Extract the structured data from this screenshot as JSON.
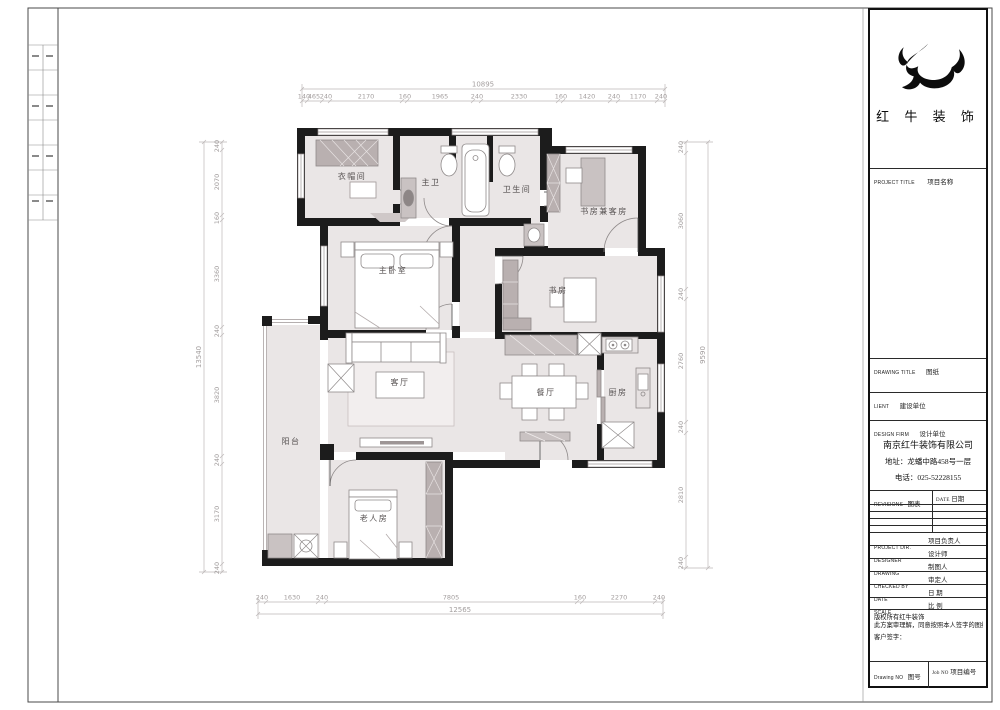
{
  "title_block": {
    "brand": "红 牛 装 饰",
    "rows": {
      "project_title_en": "PROJECT TITLE",
      "project_title_cn": "项目名称",
      "drawing_title_en": "DRAWING TITLE",
      "drawing_title_cn": "图纸",
      "client_en": "LIENT",
      "client_cn": "建设单位",
      "design_firm_en": "DESIGN FIRM",
      "design_firm_cn": "设计单位"
    },
    "company": {
      "name": "南京红牛装饰有限公司",
      "address": "地址：龙蟠中路458号一层",
      "phone": "电话：025-52228155"
    },
    "revisions": {
      "col1_en": "REVISIONS",
      "col1_cn": "图表",
      "col2_en": "DATE",
      "col2_cn": "日期"
    },
    "signature_rows": [
      {
        "en": "PROJECT DIR.",
        "cn": "项目负责人"
      },
      {
        "en": "DESIGNER",
        "cn": "设计师"
      },
      {
        "en": "DRAWING",
        "cn": "制图人"
      },
      {
        "en": "CHECKED BY",
        "cn": "审定人"
      },
      {
        "en": "DATE",
        "cn": "日 期"
      },
      {
        "en": "SCALE",
        "cn": "比 例"
      }
    ],
    "copyright": [
      "版权所有红牛装饰",
      "此方案审理解，同意按照本人签字的图纸施工；",
      "客户签字："
    ],
    "footer": {
      "drawing_no_en": "Drawing NO",
      "drawing_no_cn": "图号",
      "job_no_en": "Job NO",
      "job_no_cn": "项目编号"
    }
  },
  "plan": {
    "rooms": [
      {
        "label": "衣帽间"
      },
      {
        "label": "主卫"
      },
      {
        "label": "卫生间"
      },
      {
        "label": "书房兼客房"
      },
      {
        "label": "主卧室"
      },
      {
        "label": "书房"
      },
      {
        "label": "客厅"
      },
      {
        "label": "餐厅"
      },
      {
        "label": "厨房"
      },
      {
        "label": "阳台"
      },
      {
        "label": "老人房"
      }
    ],
    "dimensions": {
      "top": {
        "overall": "10895",
        "segments": [
          "140",
          "465",
          "240",
          "2170",
          "160",
          "1965",
          "240",
          "2330",
          "160",
          "1420",
          "240",
          "1170",
          "240"
        ]
      },
      "bottom": {
        "overall": "12565",
        "segments": [
          "240",
          "1630",
          "240",
          "7805",
          "160",
          "2270",
          "240"
        ]
      },
      "left": {
        "overall": "13540",
        "segments": [
          "240",
          "2070",
          "160",
          "3360",
          "240",
          "3820",
          "240",
          "3170",
          "240"
        ]
      },
      "right": {
        "overall": "9590",
        "segments": [
          "240",
          "3060",
          "240",
          "2760",
          "240",
          "2810",
          "240"
        ]
      }
    },
    "colors": {
      "wall": "#1c1c1c",
      "floor": "#eae6e6",
      "cabinet": "#b9b0b0",
      "dimension": "#a39e9e"
    }
  }
}
